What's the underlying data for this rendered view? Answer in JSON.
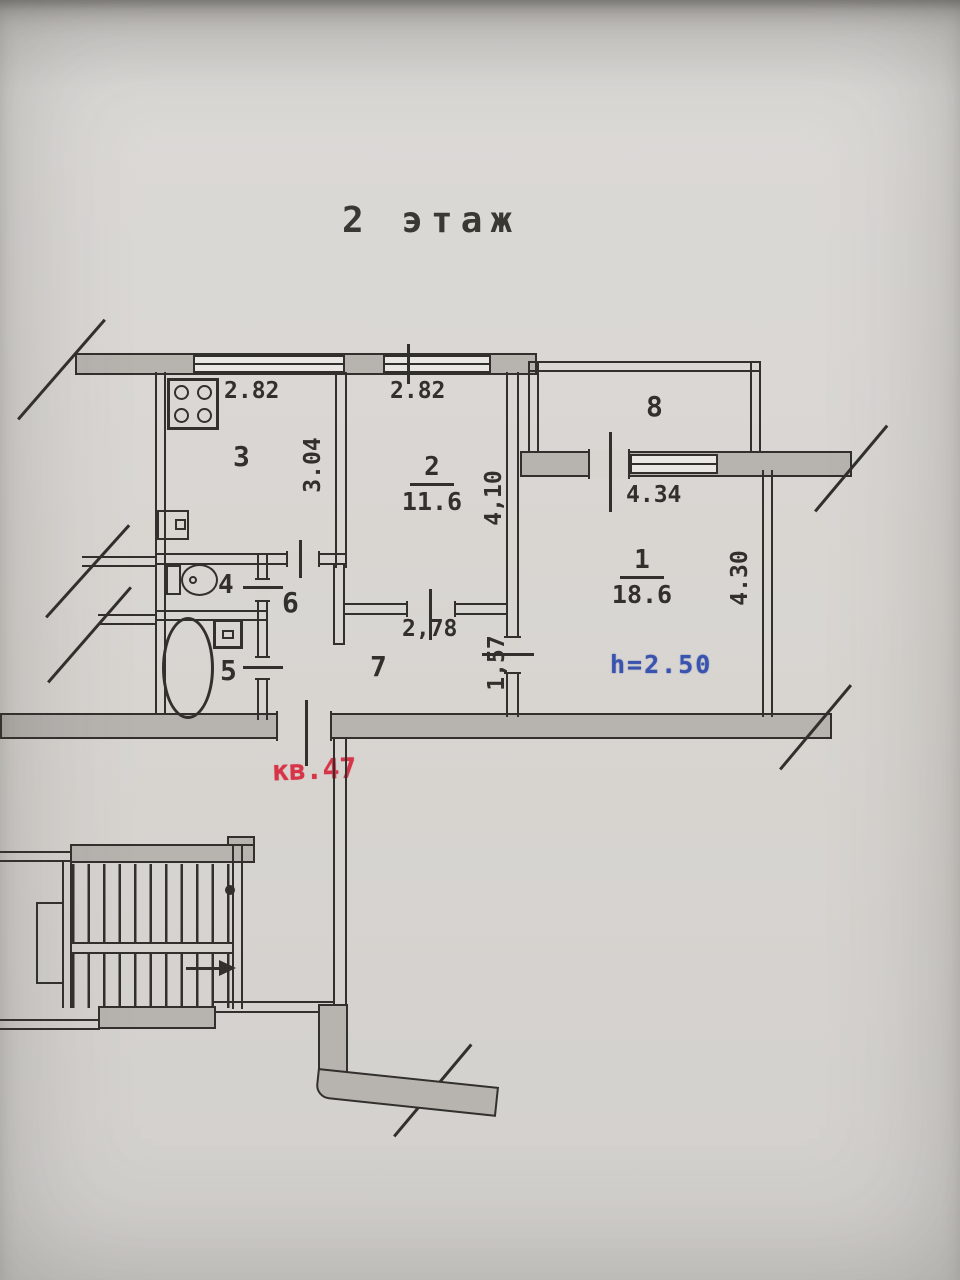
{
  "document": {
    "floor_title": "2 этаж",
    "apartment_stamp": "кв.47",
    "height_stamp": "h=2.50"
  },
  "rooms": {
    "r1": {
      "number": "1",
      "area": "18.6"
    },
    "r2": {
      "number": "2",
      "area": "11.6"
    },
    "r3": {
      "number": "3"
    },
    "r4": {
      "number": "4"
    },
    "r5": {
      "number": "5"
    },
    "r6": {
      "number": "6"
    },
    "r7": {
      "number": "7"
    },
    "r8": {
      "number": "8"
    }
  },
  "dimensions": {
    "kitchen_width": "2.82",
    "room2_width": "2.82",
    "kitchen_depth": "3.04",
    "room2_depth": "4,10",
    "room1_width": "4.34",
    "room1_depth": "4.30",
    "hall7_width": "2,78",
    "hall7_corridor": "1,57"
  },
  "icons": {
    "stove": "stove-icon",
    "toilet": "toilet-icon",
    "bathtub": "bathtub-icon",
    "sink": "sink-icon",
    "kitchen_sink": "kitchen-sink-icon",
    "staircase": "staircase",
    "arrow": "stair-direction-arrow",
    "dot": "stair-start-dot"
  },
  "colors": {
    "paper": "#d8d5d1",
    "ink": "#32302c",
    "wall_fill": "#b7b4b0",
    "window_fill": "#e9e7e3",
    "stamp_red": "#d73448",
    "stamp_blue": "#3a53ae"
  }
}
